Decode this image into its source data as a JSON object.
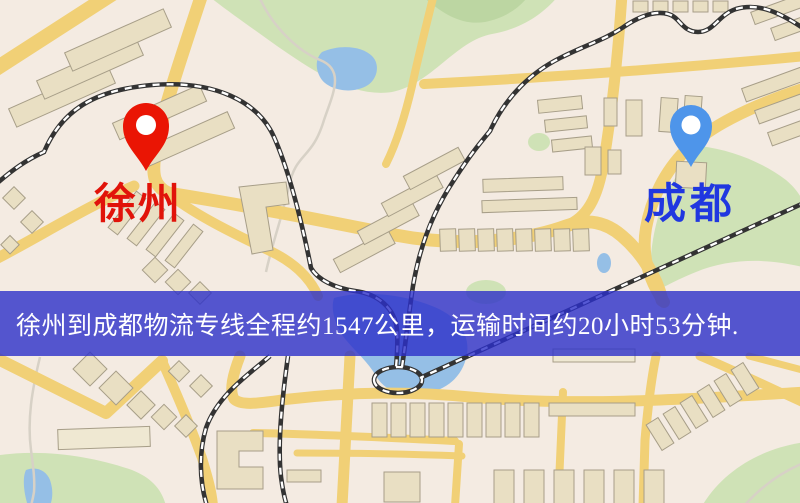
{
  "map": {
    "origin_marker": {
      "label": "徐州",
      "pin_color": "#ea1504",
      "label_color": "#e1130a"
    },
    "destination_marker": {
      "label": "成都",
      "pin_color": "#4e95ea",
      "label_color": "#2037e0"
    },
    "banner": {
      "text": "徐州到成都物流专线全程约1547公里，运输时间约20小时53分钟.",
      "background_color": "#2c2fc9",
      "text_color": "#ffffff"
    },
    "route": {
      "distance_text": "约1547公里",
      "duration_text": "约20小时53分钟"
    },
    "palette": {
      "land": "#f4ebe2",
      "road": "#f1d076",
      "park": "#cfe2b6",
      "water": "#95bfe6",
      "building": "#e9dfc3",
      "railway": "#333333"
    }
  }
}
